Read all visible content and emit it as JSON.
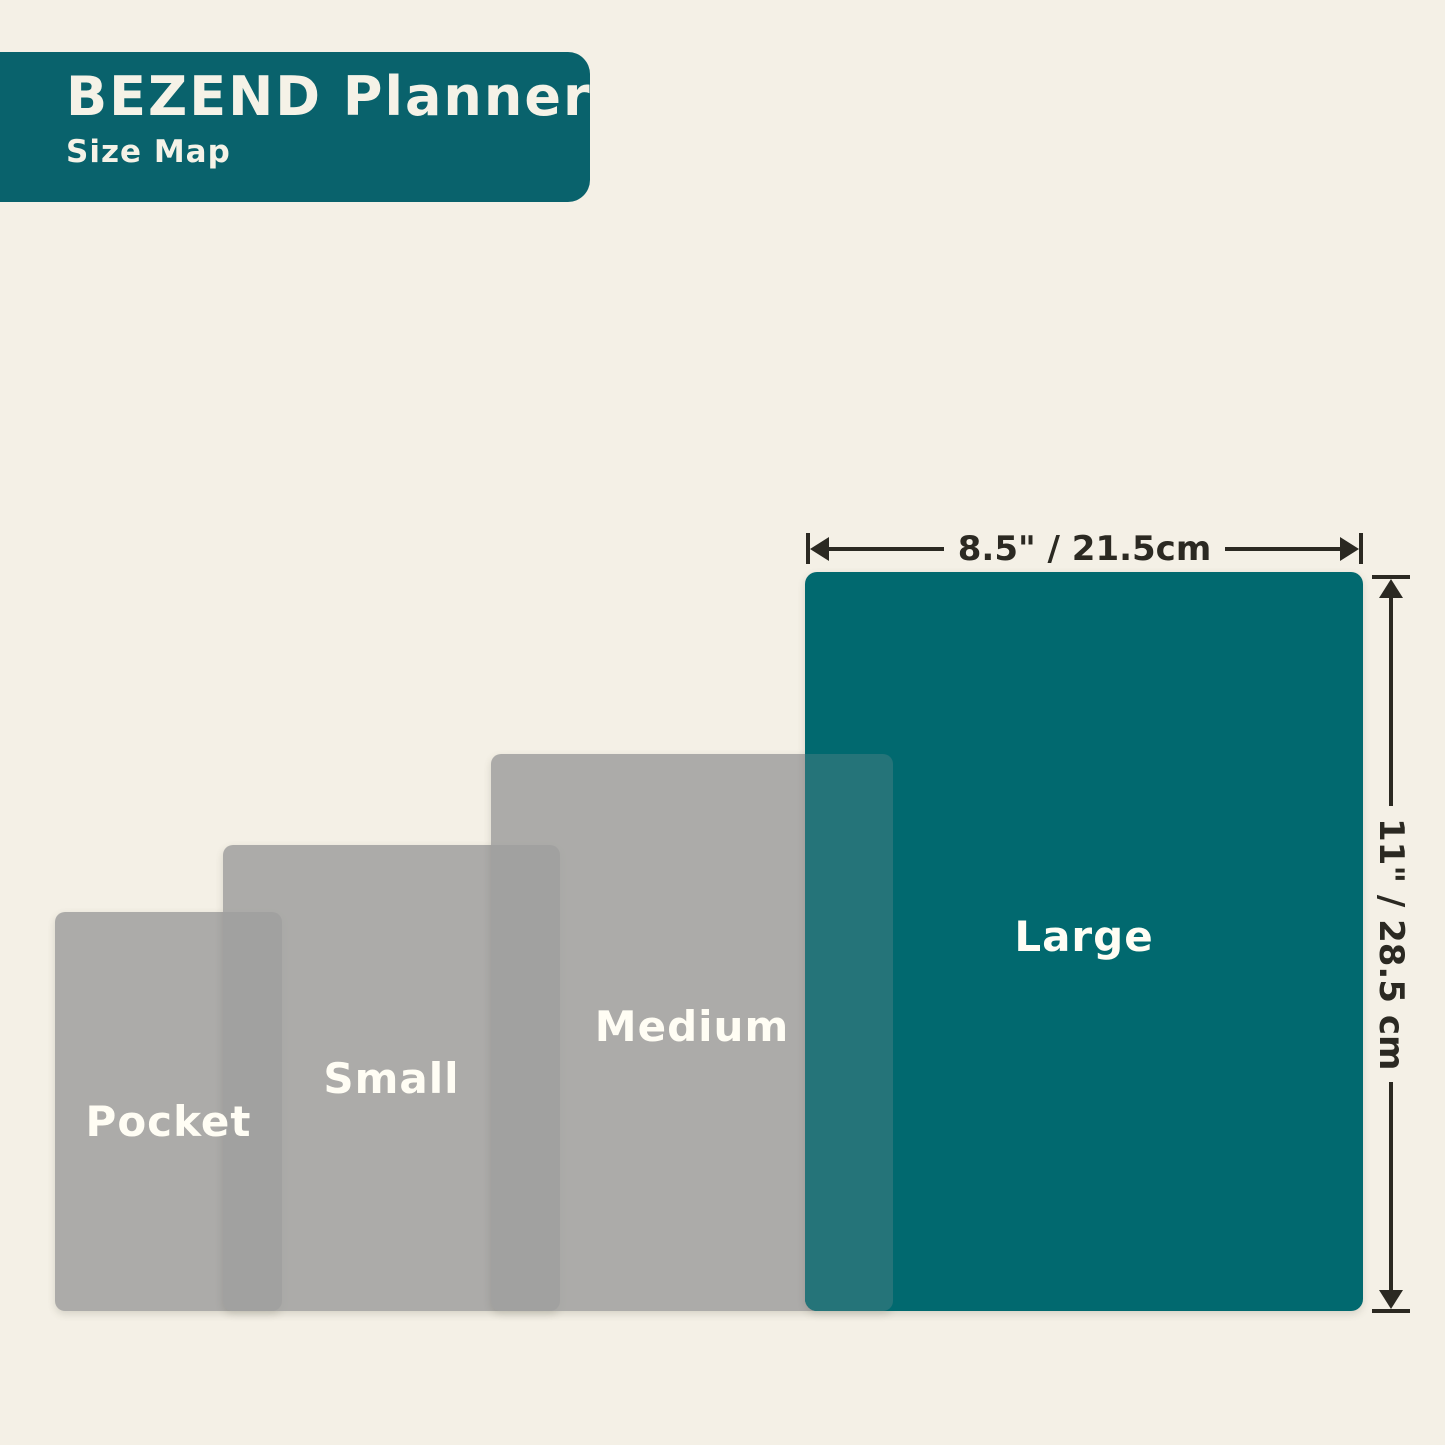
{
  "header": {
    "title": "BEZEND Planner",
    "subtitle": "Size Map"
  },
  "planner_sizes": [
    {
      "label": "Pocket",
      "highlighted": false
    },
    {
      "label": "Small",
      "highlighted": false
    },
    {
      "label": "Medium",
      "highlighted": false
    },
    {
      "label": "Large",
      "highlighted": true
    }
  ],
  "dimension_annotations": {
    "width_label": "8.5\" / 21.5cm",
    "height_label": "11\" / 28.5 cm"
  },
  "palette": {
    "background": "#F4F0E6",
    "header_teal": "#09626C",
    "large_teal": "#01696F",
    "overlap_teal": "#257479",
    "gray_rect": "#ABABA9",
    "gray_overlap": "#A2A2A0",
    "dimension_ink": "#2B2922",
    "label_text": "#FFFDF4"
  }
}
